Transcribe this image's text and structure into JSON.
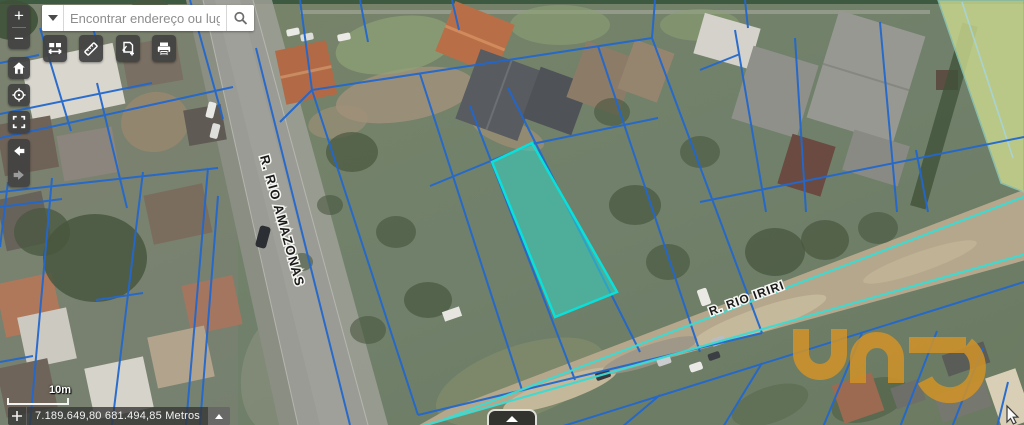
{
  "search": {
    "placeholder": "Encontrar endereço ou lugar",
    "dropdown_icon": "caret-down-icon",
    "submit_icon": "magnifier-icon"
  },
  "controls": {
    "zoom_in": "+",
    "zoom_out": "−",
    "home_icon": "home-icon",
    "locate_icon": "crosshair-compass-icon",
    "fullscreen_icon": "fullscreen-corners-icon",
    "previous_extent_icon": "arrow-left-icon",
    "next_extent_icon": "arrow-right-icon"
  },
  "tools": {
    "items": [
      {
        "icon": "swipe-compare-icon"
      },
      {
        "icon": "measure-ruler-icon"
      },
      {
        "icon": "map-select-add-icon"
      },
      {
        "icon": "printer-icon"
      }
    ]
  },
  "map": {
    "street_labels": [
      {
        "text": "R. RIO AMAZONAS"
      },
      {
        "text": "R. RIO IRIRI"
      }
    ],
    "selected_parcel_stroke": "#0ae0da",
    "selected_parcel_fill": "#2fd8c8",
    "parcel_line_color": "#2267cd",
    "utility_line_color": "#3ddbd2",
    "greenspace_color": "#cbd88e"
  },
  "scalebar": {
    "label": "10m"
  },
  "statusbar": {
    "coordinates": "7.189.649,80 681.494,85 Metros",
    "crosshair_icon": "plus-crosshair-icon",
    "collapse_icon": "caret-up-icon"
  },
  "bottom_panel": {
    "expand_icon": "caret-up-icon"
  },
  "watermark": {
    "text": "una",
    "color": "#d29327"
  }
}
